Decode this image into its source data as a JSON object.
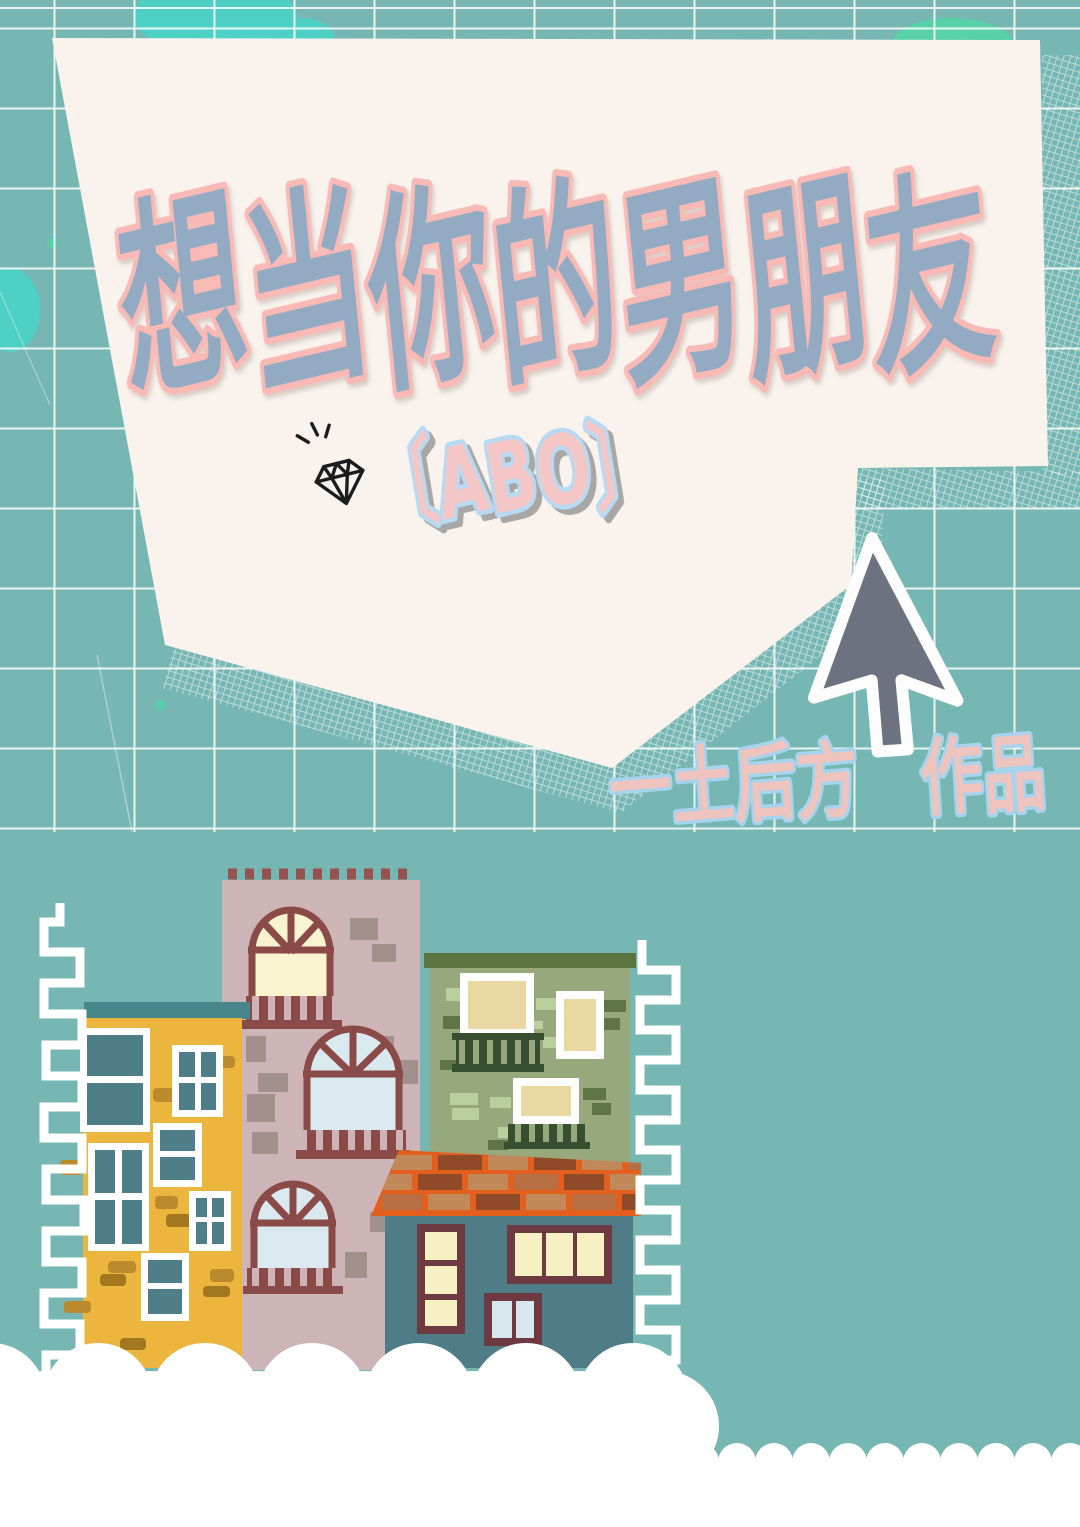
{
  "cover": {
    "title": "想当你的男朋友",
    "subtitle": "〔ABO〕",
    "author_credit": "一土后方　作品",
    "colors": {
      "background_teal": "#76b7b3",
      "grid_line": "#ffffff",
      "paper_cream": "#f9f2ed",
      "title_fill": "#92abc2",
      "title_outline": "#f9bab6",
      "subtitle_fill": "#f4c6c6",
      "subtitle_outline": "#b7daf2",
      "author_fill": "#efc4bf",
      "author_outline": "#a8d3ed",
      "accent_cyan_blob": "#4ed0c5",
      "accent_mint_blob": "#58d0a8",
      "cursor_gray": "#6d7280",
      "yellow_building": "#ebb53e",
      "yellow_roof_strip": "#47868b",
      "pink_building": "#cdb4b6",
      "maroon_frame": "#8a4a47",
      "green_building": "#97a87c",
      "green_roof_strip": "#5c7440",
      "teal_house": "#4e7d87",
      "roof_orange": "#e35f1e",
      "cloud_white": "#ffffff"
    },
    "icons": {
      "diamond": "diamond-sparkle-icon",
      "cursor": "mouse-cursor-icon"
    }
  }
}
